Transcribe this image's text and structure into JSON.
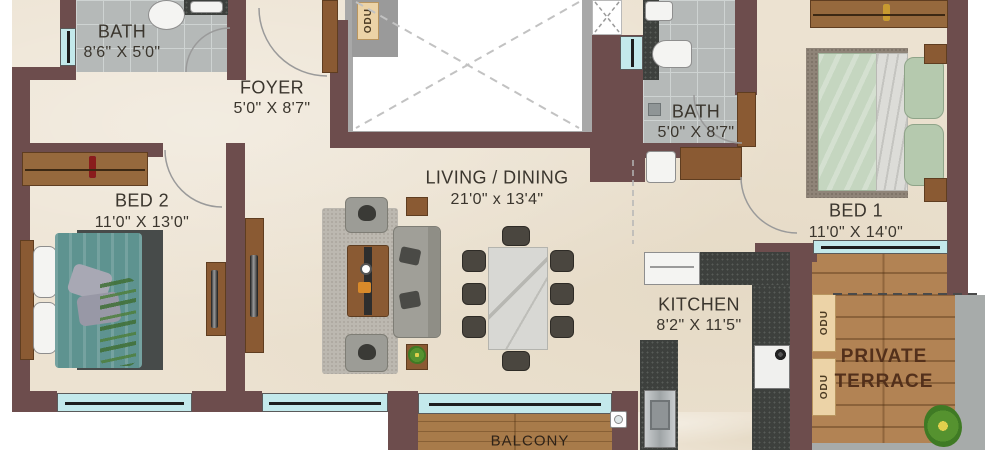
{
  "title": "Apartment floor plan",
  "colors": {
    "wall": "#6d4d4d",
    "floor": "#ece2d1",
    "bath_tile": "#b5b9b8",
    "window": "#c3e9eb",
    "wood": "#8a5a33",
    "terrace_deck": "#b28354",
    "balcony_deck": "#a87b4a",
    "kitchen_counter": "#3d403d",
    "label_text": "#3b362e",
    "terrace_text": "#53301b"
  },
  "rooms": {
    "bath1": {
      "name": "BATH",
      "dims": "8'6\" X 5'0\""
    },
    "foyer": {
      "name": "FOYER",
      "dims": "5'0\" X 8'7\""
    },
    "bath2": {
      "name": "BATH",
      "dims": "5'0\" X 8'7\""
    },
    "bed2": {
      "name": "BED 2",
      "dims": "11'0\" X 13'0\""
    },
    "living": {
      "name": "LIVING / DINING",
      "dims": "21'0\" x 13'4\""
    },
    "bed1": {
      "name": "BED 1",
      "dims": "11'0\" X 14'0\""
    },
    "kitchen": {
      "name": "KITCHEN",
      "dims": "8'2\" X 11'5\""
    },
    "terrace": {
      "line1": "PRIVATE",
      "line2": "TERRACE"
    },
    "balcony": {
      "name": "BALCONY"
    }
  },
  "labels": {
    "odu": "ODU"
  }
}
